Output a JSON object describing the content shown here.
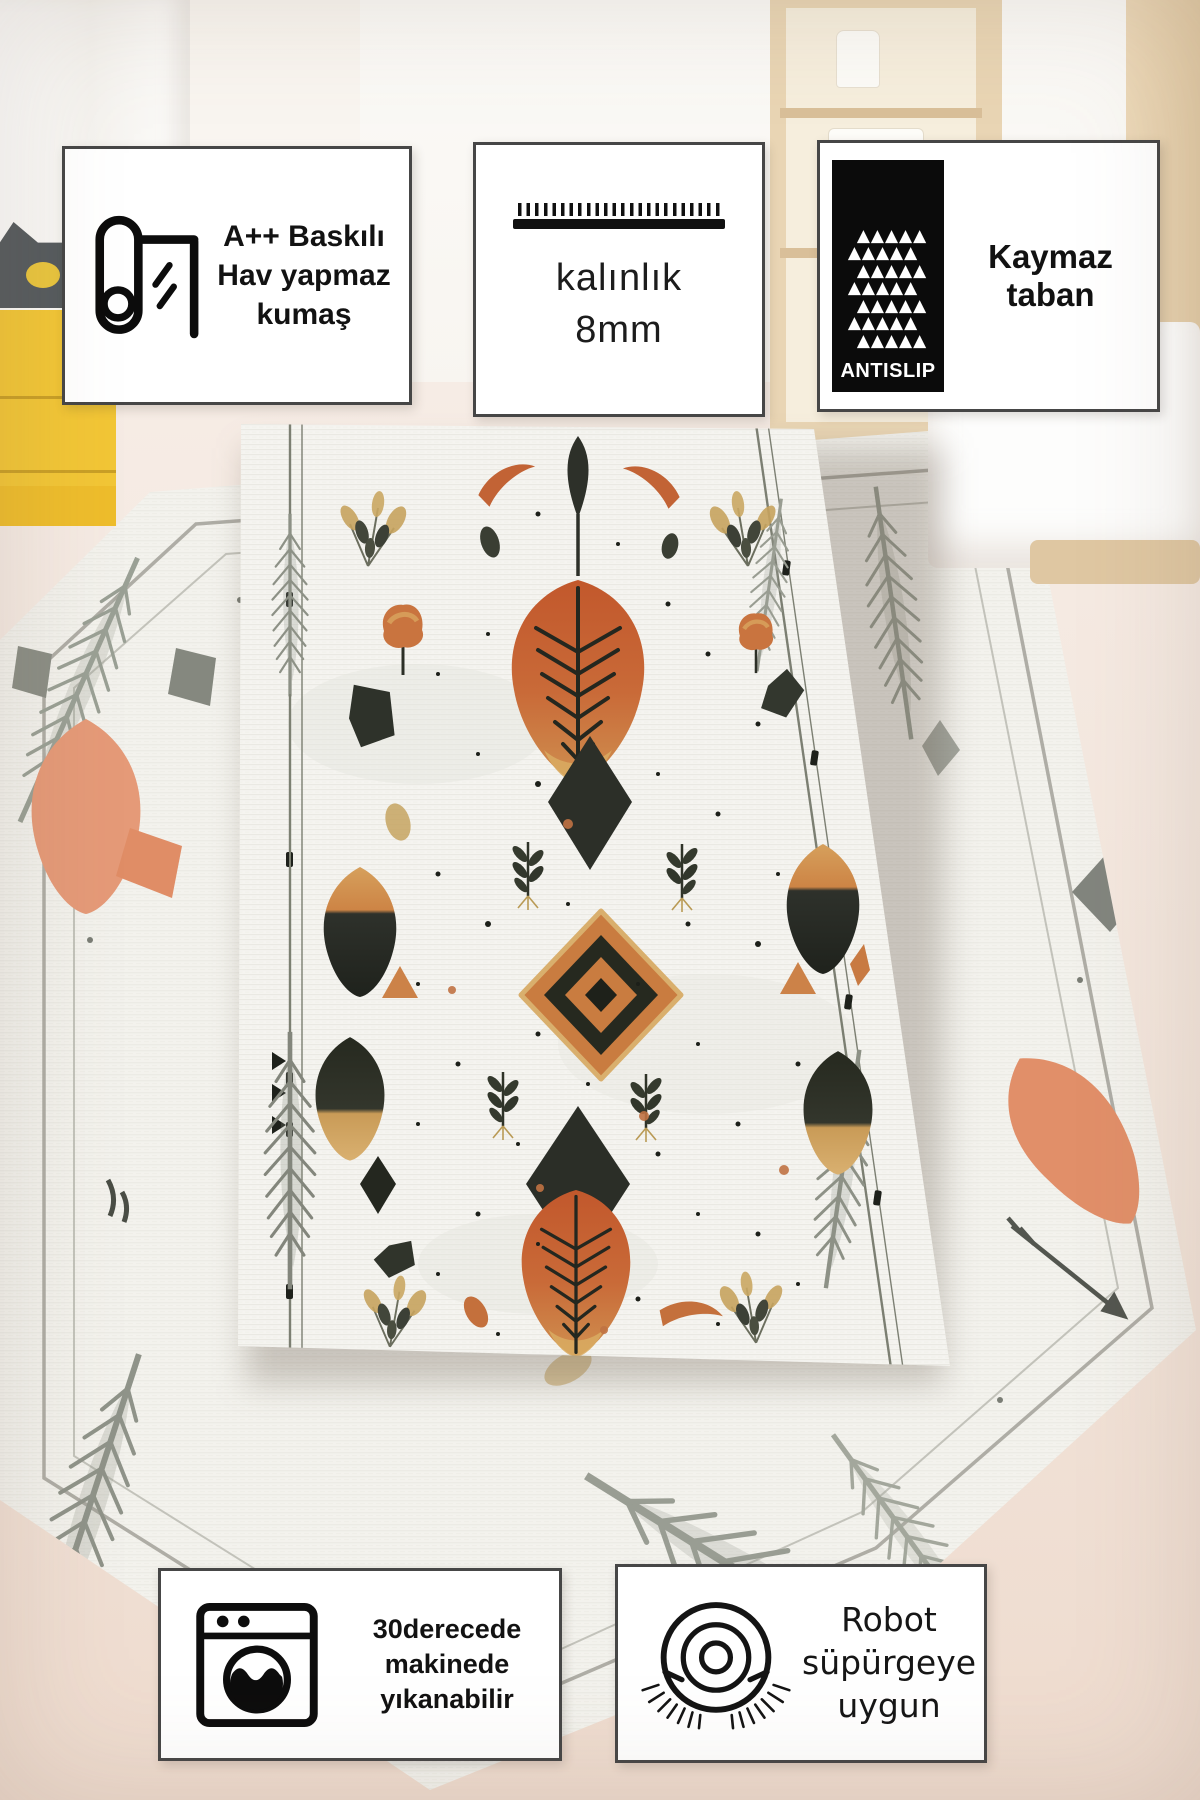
{
  "palette": {
    "badge_border": "#464646",
    "badge_bg": "#ffffff",
    "icon_ink": "#0d0d0d",
    "rug_orange": "#c9713c",
    "rug_gold": "#cfa35f",
    "rug_dark": "#2c2f28",
    "rug_gray": "#8d9186",
    "back_rug_salmon": "#e59a78",
    "floor": "#f3e9e1",
    "wood": "#e9d5b4",
    "cabinet_yellow": "#f2c636",
    "antislip_box": "#0b0b0b"
  },
  "badges": {
    "top": [
      {
        "id": "fabric",
        "icon": "rug-roll-icon",
        "lines": [
          "A++ Baskılı",
          "Hav yapmaz",
          "kumaş"
        ]
      },
      {
        "id": "thickness",
        "icon": "pile-height-comb-icon",
        "lines": [
          "kalınlık",
          "8mm"
        ]
      },
      {
        "id": "antislip",
        "icon": "antislip-triangle-grid-icon",
        "icon_label": "ANTISLIP",
        "icon_rows": [
          "▲▲▲▲▲",
          "▲▲▲▲▲",
          "▲▲▲▲▲",
          "▲▲▲▲▲",
          "▲▲▲▲▲",
          "▲▲▲▲▲",
          "▲▲▲▲▲"
        ],
        "lines": [
          "Kaymaz taban"
        ]
      }
    ],
    "bottom": [
      {
        "id": "machine-washable",
        "icon": "washing-machine-icon",
        "lines": [
          "30derecede",
          "makinede",
          "yıkanabilir"
        ]
      },
      {
        "id": "robot-vacuum",
        "icon": "robot-vacuum-icon",
        "lines": [
          "Robot",
          "süpürgeye",
          "uygun"
        ]
      }
    ]
  }
}
